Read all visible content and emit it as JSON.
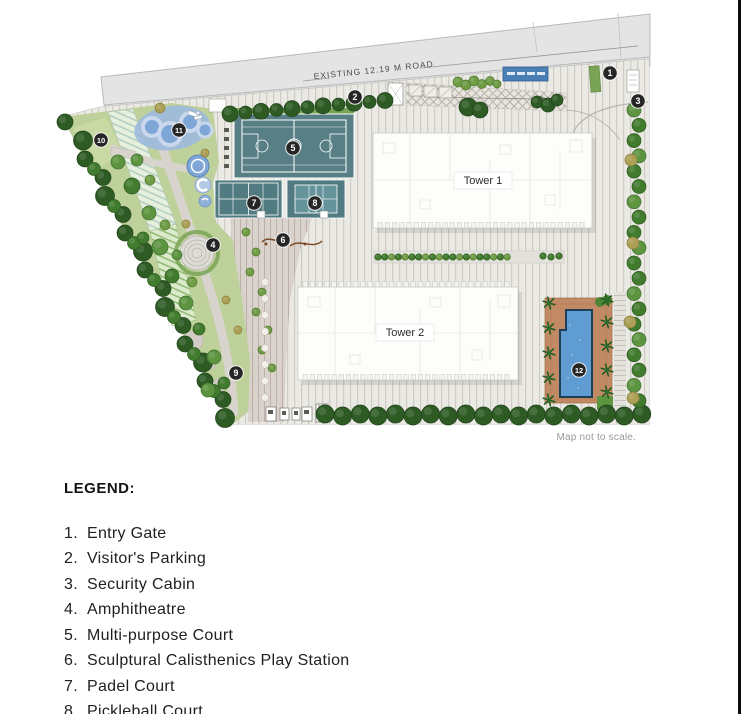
{
  "page": {
    "map_disclaimer": "Map not to scale."
  },
  "map": {
    "road_label": "EXISTING 12.19 M ROAD",
    "tower1_label": "Tower 1",
    "tower2_label": "Tower 2",
    "markers": [
      {
        "n": "1",
        "x": 610,
        "y": 73
      },
      {
        "n": "2",
        "x": 355,
        "y": 97
      },
      {
        "n": "3",
        "x": 638,
        "y": 101
      },
      {
        "n": "4",
        "x": 213,
        "y": 245
      },
      {
        "n": "5",
        "x": 293,
        "y": 148
      },
      {
        "n": "6",
        "x": 283,
        "y": 240
      },
      {
        "n": "7",
        "x": 254,
        "y": 203
      },
      {
        "n": "8",
        "x": 315,
        "y": 203
      },
      {
        "n": "9",
        "x": 236,
        "y": 373
      },
      {
        "n": "10",
        "x": 101,
        "y": 140
      },
      {
        "n": "11",
        "x": 179,
        "y": 130
      },
      {
        "n": "12",
        "x": 579,
        "y": 370
      }
    ],
    "colors": {
      "marker": "#262626",
      "court": "#587f86",
      "water": "#8fb0d8",
      "pool": "#5f9cd1",
      "deck": "#c28a64",
      "tree_dark": "#2e5b24",
      "tree_mid": "#417c2e",
      "tree_light": "#5d9440",
      "olive": "#ac9f56",
      "road": "#e4e4e4",
      "canopy_blue": "#4a7fb5"
    }
  },
  "legend": {
    "title": "LEGEND:",
    "items": [
      {
        "num": "1.",
        "label": "Entry Gate"
      },
      {
        "num": "2.",
        "label": "Visitor's Parking"
      },
      {
        "num": "3.",
        "label": "Security Cabin"
      },
      {
        "num": "4.",
        "label": "Amphitheatre"
      },
      {
        "num": "5.",
        "label": "Multi-purpose Court"
      },
      {
        "num": "6.",
        "label": "Sculptural Calisthenics Play Station"
      },
      {
        "num": "7.",
        "label": "Padel Court"
      },
      {
        "num": "8.",
        "label": "Pickleball Court"
      }
    ]
  }
}
